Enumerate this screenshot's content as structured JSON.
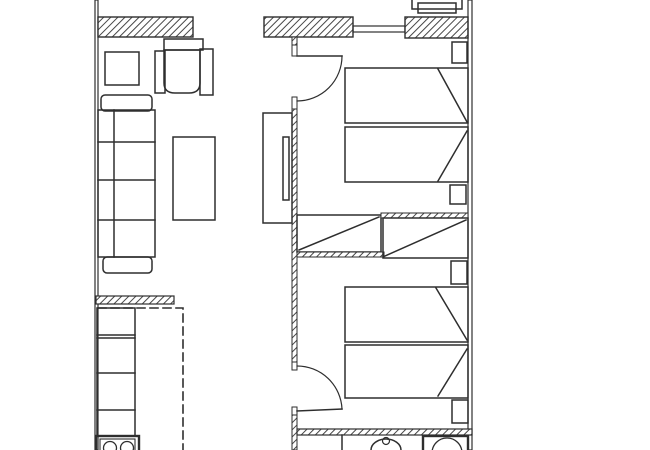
{
  "canvas": {
    "width": 650,
    "height": 450,
    "background_color": "#ffffff",
    "line_color": "#2e2e2e",
    "hatch_color": "#474747",
    "dash_pattern": "8 5"
  },
  "floorplan": {
    "type": "apartment-floor-plan",
    "rooms": [
      "living-room",
      "kitchen",
      "bedroom-1",
      "bedroom-2",
      "bathroom",
      "balcony"
    ],
    "furniture": [
      "sofa",
      "armchair",
      "side-table",
      "coffee-table",
      "tv-cabinet",
      "tv",
      "kitchen-counter",
      "hob",
      "wardrobe-left",
      "wardrobe-right",
      "double-bed-1",
      "double-bed-2",
      "nightstand-1",
      "nightstand-2",
      "nightstand-3",
      "nightstand-4",
      "bathroom-sink",
      "washbasin-unit",
      "balcony-furniture"
    ],
    "openings": [
      "bedroom-1-door",
      "bedroom-2-door",
      "balcony-window",
      "terrace-opening"
    ]
  }
}
